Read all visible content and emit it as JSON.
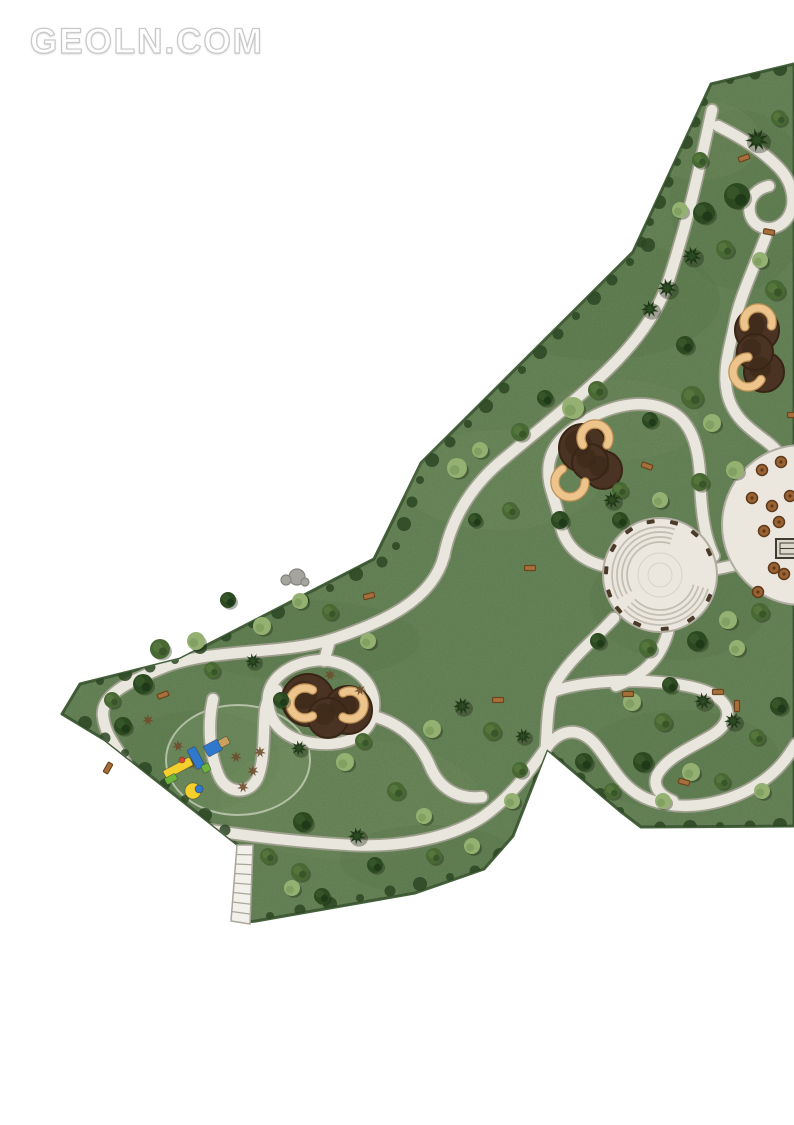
{
  "watermark": {
    "text": "GEOLN.COM"
  },
  "map": {
    "description": "park-landscape-master-plan",
    "canvas": {
      "width": 794,
      "height": 1125
    },
    "colors": {
      "background": "#ffffff",
      "grass": "#6d8c5d",
      "grass_dark": "#587a49",
      "grass_light": "#7e9b69",
      "edge": "#44603a",
      "hedge": "#2c4723",
      "path_fill": "#e9e6dd",
      "path_edge": "#a8a498",
      "plaza_fill": "#ebe7df",
      "plaza_line": "#c3bfb3",
      "plaza_rim": "#b0aca0",
      "mulch": "#4a3322",
      "mulch_dark": "#382515",
      "bench_arc": "#ecc48c",
      "bench_arc_edge": "#bd8f53",
      "tree_dark": "#2c4a22",
      "tree_darker": "#1d3616",
      "tree_mid": "#48683485",
      "tree_mid_solid": "#486834",
      "tree_mid_dark": "#38562a",
      "tree_light": "#94b172",
      "tree_light_dark": "#7d9c5c",
      "shrub_brown": "#6f4c2c",
      "bench_wood": "#a76f3a",
      "bench_edge": "#6b4420",
      "rock": "#a5a49e",
      "rock_edge": "#85847c",
      "stairs_fill": "#f2f0ea",
      "stairs_line": "#a9a69a",
      "table_fill": "#9a6233",
      "table_edge": "#5e3a1c",
      "kiosk_fill": "#ddd8cc",
      "kiosk_edge": "#413c31",
      "blue": "#2f78cc",
      "yellow": "#f4cf2e",
      "green": "#6cb43a",
      "red": "#d6452f",
      "tan": "#c9a15f"
    },
    "outline": "M 711,84 L 794,64 L 794,826 L 641,827 L 620,811 L 547,749 L 513,836 L 484,869 L 415,893 L 256,921 L 246,922 L 238,845 L 105,740 L 62,714 L 80,684 L 180,659 L 374,559 L 421,463 L 633,252 Z",
    "mottles": [
      [
        600,
        300,
        120,
        60,
        "d",
        0.22
      ],
      [
        500,
        480,
        100,
        50,
        "l",
        0.28
      ],
      [
        680,
        600,
        90,
        60,
        "d",
        0.18
      ],
      [
        300,
        640,
        120,
        40,
        "d",
        0.2
      ],
      [
        350,
        800,
        130,
        60,
        "l",
        0.24
      ],
      [
        680,
        760,
        100,
        50,
        "d",
        0.18
      ],
      [
        200,
        760,
        80,
        50,
        "d",
        0.16
      ],
      [
        740,
        200,
        70,
        90,
        "d",
        0.18
      ],
      [
        620,
        420,
        80,
        40,
        "l",
        0.26
      ],
      [
        430,
        860,
        90,
        35,
        "d",
        0.2
      ],
      [
        700,
        140,
        60,
        40,
        "l",
        0.25
      ]
    ],
    "paths": [
      "M 712,110 C 700,165 690,215 668,282 C 646,348 580,395 505,458 C 475,482 452,515 444,556",
      "M 444,556 C 432,600 385,622 330,640 C 280,655 210,648 162,668 C 125,683 101,696 103,716 C 105,736 118,748 126,764",
      "M 126,764 C 136,800 158,820 198,828 C 245,836 300,842 350,845 C 405,848 455,836 484,816 C 512,796 530,770 546,748",
      "M 546,748 C 560,729 578,727 593,742 C 610,759 618,788 650,800 C 690,814 738,801 768,777 C 783,765 790,753 796,744",
      "M 552,692 C 594,676 682,678 712,694 C 734,706 732,724 709,737 C 690,748 670,756 659,772 C 651,784 658,795 673,801",
      "M 614,618 C 592,642 568,660 554,686 C 548,700 547,724 546,748",
      "M 604,566 C 580,560 564,545 560,522 C 556,498 546,486 549,464 C 553,440 572,428 594,416 C 622,402 650,400 672,412 C 692,423 699,448 700,478 C 701,508 704,536 714,556",
      "M 712,570 L 750,562",
      "M 668,632 C 660,660 642,676 616,686",
      "M 718,126 C 742,138 764,152 779,168 C 794,184 798,208 784,222 C 772,233 754,229 750,214 C 747,200 755,189 769,186",
      "M 766,236 C 753,270 739,300 735,322 C 731,344 722,368 727,392 C 732,417 750,429 766,441 C 779,451 787,463 791,475",
      "M 322,660 C 288,662 266,680 268,703 C 270,728 292,744 326,744 C 358,744 374,727 374,704 C 374,682 353,662 322,660",
      "M 330,640 L 324,661",
      "M 213,699 C 207,726 210,756 219,776 C 227,794 250,796 258,777 C 265,759 263,734 265,712 C 266,702 270,695 277,690",
      "M 373,716 C 402,724 420,742 430,766 C 439,788 458,800 482,797"
    ],
    "plaza": {
      "cx": 660,
      "cy": 575,
      "r": 57,
      "bands": [
        {
          "a0": 150,
          "a1": 288,
          "radii": [
            33,
            38,
            43,
            48
          ]
        },
        {
          "a0": 16,
          "a1": 140,
          "radii": [
            35,
            40,
            45,
            50
          ]
        }
      ],
      "bench_angles": [
        160,
        185,
        210,
        235,
        260,
        285,
        310,
        335,
        25,
        55,
        85,
        115,
        140
      ],
      "inner_rings": [
        12,
        22
      ]
    },
    "plaza2": {
      "cx": 802,
      "cy": 525,
      "r": 80,
      "tables": [
        [
          762,
          470
        ],
        [
          781,
          462
        ],
        [
          752,
          498
        ],
        [
          772,
          506
        ],
        [
          790,
          496
        ],
        [
          764,
          531
        ],
        [
          779,
          522
        ],
        [
          774,
          568
        ],
        [
          784,
          574
        ],
        [
          758,
          592
        ]
      ],
      "kiosk": {
        "x": 776,
        "y": 539,
        "w": 26,
        "h": 19
      }
    },
    "mulch_nodes": [
      {
        "blobs": [
          [
            308,
            700,
            26
          ],
          [
            348,
            710,
            24
          ],
          [
            328,
            718,
            20
          ]
        ],
        "arcs": [
          [
            305,
            703,
            15,
            60,
            300
          ],
          [
            350,
            705,
            14,
            240,
            480
          ]
        ]
      },
      {
        "blobs": [
          [
            583,
            448,
            24
          ],
          [
            603,
            470,
            19
          ],
          [
            590,
            462,
            18
          ]
        ],
        "arcs": [
          [
            595,
            438,
            14,
            150,
            390
          ],
          [
            570,
            482,
            15,
            0,
            240
          ]
        ]
      },
      {
        "blobs": [
          [
            757,
            330,
            22
          ],
          [
            764,
            372,
            20
          ],
          [
            755,
            352,
            18
          ]
        ],
        "arcs": [
          [
            758,
            322,
            14,
            160,
            380
          ],
          [
            748,
            372,
            15,
            30,
            270
          ]
        ]
      }
    ],
    "playground": {
      "circle": {
        "cx": 238,
        "cy": 760,
        "rx": 72,
        "ry": 55
      },
      "shapes": [
        {
          "t": "rect",
          "x": 178,
          "y": 768,
          "w": 30,
          "h": 9,
          "rot": -28,
          "f": "yellow"
        },
        {
          "t": "rect",
          "x": 196,
          "y": 758,
          "w": 9,
          "h": 22,
          "rot": -28,
          "f": "blue"
        },
        {
          "t": "circle",
          "x": 193,
          "y": 791,
          "r": 8,
          "f": "yellow"
        },
        {
          "t": "circle",
          "x": 199,
          "y": 789,
          "r": 4,
          "f": "blue"
        },
        {
          "t": "rect",
          "x": 213,
          "y": 748,
          "w": 16,
          "h": 12,
          "rot": -28,
          "f": "blue"
        },
        {
          "t": "rect",
          "x": 224,
          "y": 742,
          "w": 10,
          "h": 8,
          "rot": -28,
          "f": "tan"
        },
        {
          "t": "rect",
          "x": 171,
          "y": 779,
          "w": 12,
          "h": 7,
          "rot": -28,
          "f": "green"
        },
        {
          "t": "rect",
          "x": 206,
          "y": 768,
          "w": 8,
          "h": 8,
          "rot": -28,
          "f": "green"
        },
        {
          "t": "circle",
          "x": 182,
          "y": 760,
          "r": 3,
          "f": "red"
        }
      ]
    },
    "stairs": {
      "poly": "237,845 253,845 250,924 231,921",
      "rungs": 8
    },
    "rock": {
      "blobs": [
        [
          297,
          577,
          8
        ],
        [
          286,
          580,
          5
        ],
        [
          305,
          582,
          4
        ]
      ]
    },
    "trees": [
      [
        757,
        140,
        "p",
        12
      ],
      [
        737,
        196,
        "d",
        13
      ],
      [
        704,
        213,
        "d",
        11
      ],
      [
        725,
        249,
        "m",
        9
      ],
      [
        692,
        256,
        "p",
        10
      ],
      [
        667,
        288,
        "p",
        10
      ],
      [
        650,
        309,
        "p",
        9
      ],
      [
        775,
        290,
        "m",
        10
      ],
      [
        760,
        260,
        "l",
        8
      ],
      [
        680,
        210,
        "l",
        8
      ],
      [
        700,
        160,
        "m",
        8
      ],
      [
        779,
        118,
        "m",
        8
      ],
      [
        573,
        408,
        "l",
        11
      ],
      [
        597,
        390,
        "m",
        9
      ],
      [
        545,
        398,
        "d",
        8
      ],
      [
        520,
        432,
        "m",
        9
      ],
      [
        457,
        468,
        "l",
        10
      ],
      [
        480,
        450,
        "l",
        8
      ],
      [
        685,
        345,
        "d",
        9
      ],
      [
        650,
        420,
        "d",
        8
      ],
      [
        692,
        397,
        "m",
        11
      ],
      [
        712,
        423,
        "l",
        9
      ],
      [
        735,
        470,
        "l",
        9
      ],
      [
        700,
        482,
        "m",
        9
      ],
      [
        660,
        500,
        "l",
        8
      ],
      [
        620,
        490,
        "m",
        8
      ],
      [
        560,
        520,
        "d",
        9
      ],
      [
        620,
        520,
        "d",
        8
      ],
      [
        510,
        510,
        "m",
        8
      ],
      [
        475,
        520,
        "d",
        7
      ],
      [
        612,
        500,
        "p",
        9
      ],
      [
        648,
        648,
        "m",
        9
      ],
      [
        697,
        641,
        "d",
        10
      ],
      [
        728,
        620,
        "l",
        9
      ],
      [
        598,
        641,
        "d",
        8
      ],
      [
        760,
        612,
        "m",
        9
      ],
      [
        737,
        648,
        "l",
        8
      ],
      [
        160,
        649,
        "m",
        10
      ],
      [
        196,
        641,
        "l",
        9
      ],
      [
        143,
        684,
        "d",
        10
      ],
      [
        262,
        626,
        "l",
        9
      ],
      [
        300,
        601,
        "l",
        8
      ],
      [
        330,
        612,
        "m",
        8
      ],
      [
        253,
        661,
        "p",
        8
      ],
      [
        212,
        670,
        "m",
        8
      ],
      [
        112,
        700,
        "m",
        8
      ],
      [
        368,
        641,
        "l",
        8
      ],
      [
        228,
        600,
        "d",
        8
      ],
      [
        123,
        726,
        "d",
        9
      ],
      [
        281,
        700,
        "d",
        8
      ],
      [
        345,
        762,
        "l",
        9
      ],
      [
        363,
        741,
        "m",
        8
      ],
      [
        299,
        748,
        "p",
        8
      ],
      [
        432,
        729,
        "l",
        9
      ],
      [
        462,
        706,
        "p",
        9
      ],
      [
        492,
        731,
        "m",
        9
      ],
      [
        523,
        736,
        "p",
        8
      ],
      [
        396,
        791,
        "m",
        9
      ],
      [
        424,
        816,
        "l",
        8
      ],
      [
        357,
        836,
        "p",
        9
      ],
      [
        303,
        822,
        "d",
        10
      ],
      [
        268,
        856,
        "m",
        8
      ],
      [
        434,
        856,
        "m",
        8
      ],
      [
        472,
        846,
        "l",
        8
      ],
      [
        512,
        801,
        "l",
        8
      ],
      [
        520,
        770,
        "m",
        8
      ],
      [
        300,
        872,
        "m",
        9
      ],
      [
        292,
        888,
        "l",
        8
      ],
      [
        322,
        896,
        "d",
        8
      ],
      [
        375,
        865,
        "d",
        8
      ],
      [
        632,
        702,
        "l",
        9
      ],
      [
        663,
        722,
        "m",
        9
      ],
      [
        703,
        701,
        "p",
        9
      ],
      [
        733,
        721,
        "p",
        9
      ],
      [
        757,
        737,
        "m",
        8
      ],
      [
        643,
        762,
        "d",
        10
      ],
      [
        691,
        772,
        "l",
        9
      ],
      [
        722,
        781,
        "m",
        8
      ],
      [
        762,
        791,
        "l",
        8
      ],
      [
        612,
        791,
        "m",
        8
      ],
      [
        584,
        762,
        "d",
        9
      ],
      [
        663,
        801,
        "l",
        8
      ],
      [
        779,
        706,
        "d",
        9
      ],
      [
        670,
        685,
        "d",
        8
      ]
    ],
    "shrubs_brown": [
      [
        236,
        757
      ],
      [
        253,
        771
      ],
      [
        243,
        787
      ],
      [
        260,
        752
      ],
      [
        178,
        746
      ],
      [
        192,
        764
      ],
      [
        148,
        720
      ],
      [
        330,
        675
      ],
      [
        360,
        690
      ]
    ],
    "benches": [
      [
        744,
        158,
        -20
      ],
      [
        769,
        232,
        10
      ],
      [
        647,
        466,
        20
      ],
      [
        369,
        596,
        -15
      ],
      [
        530,
        568,
        0
      ],
      [
        628,
        694,
        0
      ],
      [
        718,
        692,
        0
      ],
      [
        737,
        706,
        90
      ],
      [
        684,
        782,
        15
      ],
      [
        108,
        768,
        -60
      ],
      [
        163,
        695,
        -20
      ],
      [
        498,
        700,
        0
      ],
      [
        793,
        415,
        0
      ]
    ],
    "hedge": [
      [
        704,
        102
      ],
      [
        695,
        122
      ],
      [
        686,
        142
      ],
      [
        677,
        162
      ],
      [
        668,
        182
      ],
      [
        659,
        202
      ],
      [
        650,
        222
      ],
      [
        641,
        242
      ],
      [
        648,
        245
      ],
      [
        630,
        262
      ],
      [
        612,
        280
      ],
      [
        594,
        298
      ],
      [
        576,
        316
      ],
      [
        558,
        334
      ],
      [
        540,
        352
      ],
      [
        522,
        370
      ],
      [
        504,
        388
      ],
      [
        486,
        406
      ],
      [
        468,
        424
      ],
      [
        450,
        442
      ],
      [
        432,
        460
      ],
      [
        420,
        480
      ],
      [
        412,
        502
      ],
      [
        404,
        524
      ],
      [
        396,
        546
      ],
      [
        382,
        562
      ],
      [
        356,
        574
      ],
      [
        330,
        588
      ],
      [
        304,
        600
      ],
      [
        278,
        612
      ],
      [
        252,
        624
      ],
      [
        226,
        636
      ],
      [
        200,
        647
      ],
      [
        175,
        660
      ],
      [
        150,
        667
      ],
      [
        125,
        674
      ],
      [
        100,
        681
      ],
      [
        225,
        830
      ],
      [
        205,
        815
      ],
      [
        185,
        799
      ],
      [
        165,
        784
      ],
      [
        145,
        769
      ],
      [
        125,
        753
      ],
      [
        105,
        738
      ],
      [
        85,
        723
      ],
      [
        270,
        916
      ],
      [
        300,
        910
      ],
      [
        330,
        904
      ],
      [
        360,
        898
      ],
      [
        390,
        891
      ],
      [
        420,
        884
      ],
      [
        450,
        877
      ],
      [
        475,
        871
      ],
      [
        500,
        855
      ],
      [
        520,
        840
      ],
      [
        532,
        810
      ],
      [
        540,
        780
      ],
      [
        560,
        762
      ],
      [
        580,
        778
      ],
      [
        600,
        795
      ],
      [
        620,
        811
      ],
      [
        660,
        827
      ],
      [
        690,
        827
      ],
      [
        720,
        826
      ],
      [
        750,
        826
      ],
      [
        780,
        825
      ],
      [
        730,
        80
      ],
      [
        755,
        74
      ],
      [
        780,
        69
      ]
    ]
  }
}
